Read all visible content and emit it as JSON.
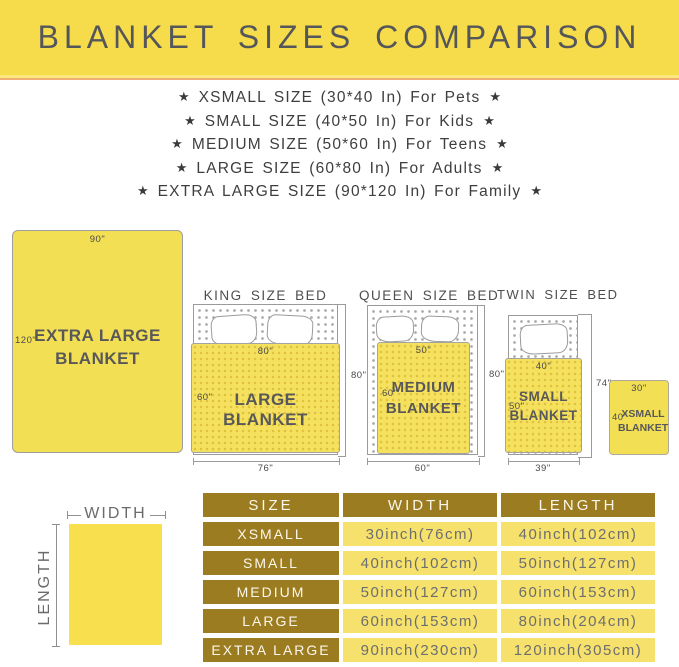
{
  "banner": {
    "title": "BLANKET SIZES COMPARISON"
  },
  "star": "★",
  "features": [
    "XSMALL SIZE (30*40 In) For Pets",
    "SMALL SIZE (40*50 In) For Kids",
    "MEDIUM SIZE (50*60 In) For Teens",
    "LARGE SIZE (60*80 In) For Adults",
    "EXTRA LARGE SIZE (90*120 In) For Family"
  ],
  "diagram": {
    "extra_large": {
      "width_label": "90\"",
      "length_label": "120\"",
      "name_line1": "EXTRA LARGE",
      "name_line2": "BLANKET"
    },
    "king": {
      "bed_title": "KING SIZE BED",
      "blanket_width": "80\"",
      "blanket_length": "60\"",
      "blanket_name": "LARGE BLANKET",
      "bed_length": "80\"",
      "bed_width": "76\""
    },
    "queen": {
      "bed_title": "QUEEN SIZE BED",
      "blanket_width": "50\"",
      "blanket_length": "60\"",
      "name_line1": "MEDIUM",
      "name_line2": "BLANKET",
      "bed_length": "80\"",
      "bed_width": "60\""
    },
    "twin": {
      "bed_title": "TWIN SIZE BED",
      "blanket_width": "40\"",
      "blanket_length": "50\"",
      "name_line1": "SMALL",
      "name_line2": "BLANKET",
      "bed_length": "74\"",
      "bed_width": "39\""
    },
    "xsmall": {
      "width_label": "30\"",
      "length_label": "40\"",
      "name_line1": "XSMALL",
      "name_line2": "BLANKET"
    }
  },
  "legend": {
    "width": "WIDTH",
    "length": "LENGTH"
  },
  "table": {
    "headers": [
      "SIZE",
      "WIDTH",
      "LENGTH"
    ],
    "rows": [
      {
        "size": "XSMALL",
        "width": "30inch(76cm)",
        "length": "40inch(102cm)"
      },
      {
        "size": "SMALL",
        "width": "40inch(102cm)",
        "length": "50inch(127cm)"
      },
      {
        "size": "MEDIUM",
        "width": "50inch(127cm)",
        "length": "60inch(153cm)"
      },
      {
        "size": "LARGE",
        "width": "60inch(153cm)",
        "length": "80inch(204cm)"
      },
      {
        "size": "EXTRA LARGE",
        "width": "90inch(230cm)",
        "length": "120inch(305cm)"
      }
    ]
  },
  "colors": {
    "banner_yellow": "#F6DC4B",
    "banner_edge_orange": "#EFAE72",
    "blanket_yellow": "#F3DF53",
    "table_gold": "#9C7C20",
    "table_cell_yellow": "#F5E16C",
    "title_gray": "#55565A"
  }
}
